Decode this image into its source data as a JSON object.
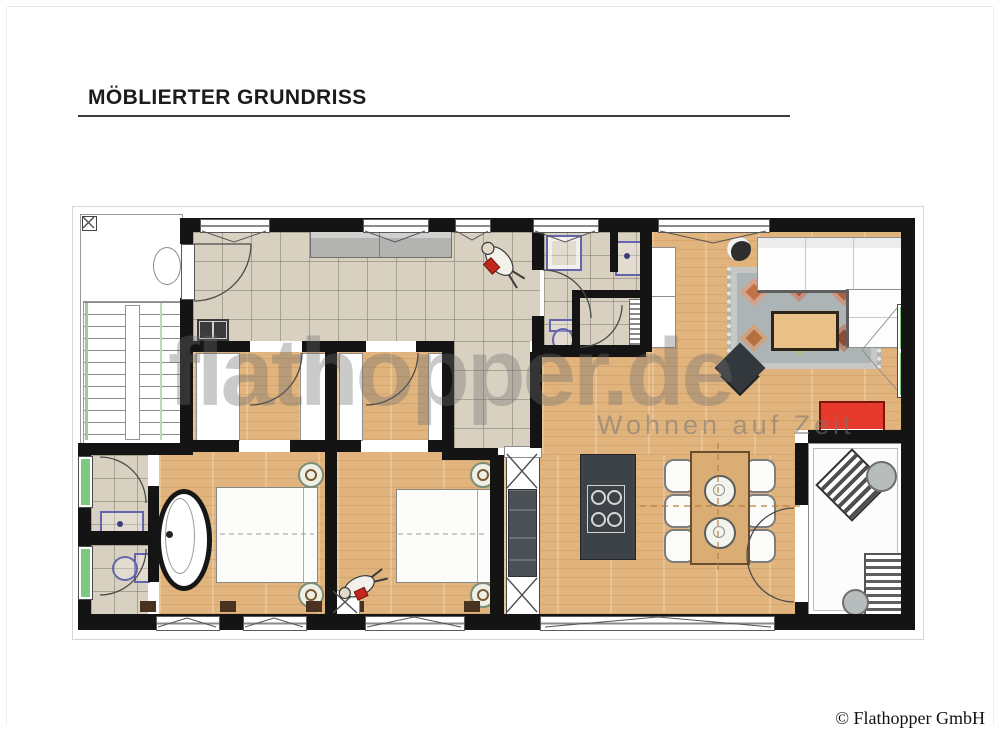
{
  "header": {
    "title": "MÖBLIERTER GRUNDRISS"
  },
  "watermark": {
    "brand": "flathopper.de",
    "tagline": "Wohnen auf Zeit"
  },
  "footer": {
    "copyright": "© Flathopper GmbH"
  },
  "colors": {
    "wall": "#141414",
    "tile_floor": "#d8d1c1",
    "wood_floor": "#e1b47d",
    "window_green": "#7dc97d",
    "accent_red": "#e53a2c",
    "kitchen_dark": "#3d4247",
    "rug_base": "#adb4b6",
    "watermark_grey": "#6e6e6e"
  }
}
